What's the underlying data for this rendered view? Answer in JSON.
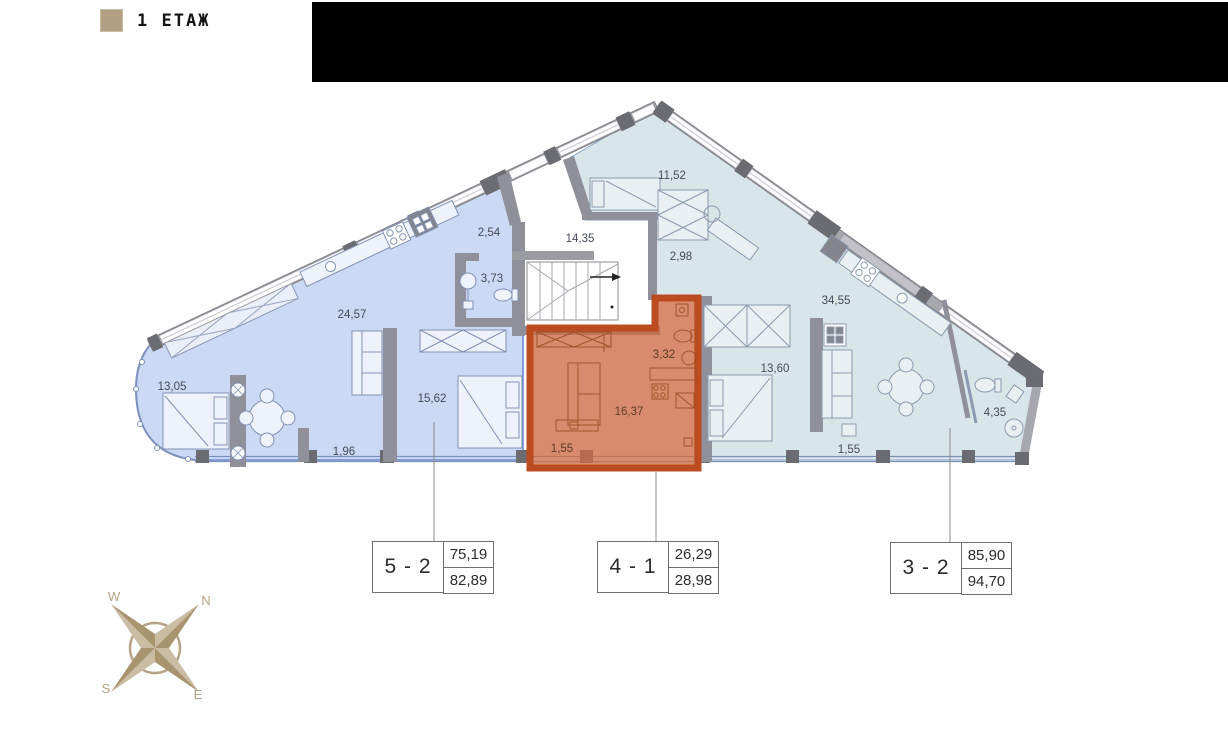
{
  "legend": {
    "floor_label": "1 ЕТАЖ",
    "swatch_color": "#b3a084"
  },
  "plan": {
    "rooms": [
      {
        "id": "left-13-05",
        "area": "13,05"
      },
      {
        "id": "left-24-57",
        "area": "24,57"
      },
      {
        "id": "left-2-54",
        "area": "2,54"
      },
      {
        "id": "left-3-73",
        "area": "3,73"
      },
      {
        "id": "left-15-62",
        "area": "15,62"
      },
      {
        "id": "left-1-96",
        "area": "1,96"
      },
      {
        "id": "stair-14-35",
        "area": "14,35"
      },
      {
        "id": "right-11-52",
        "area": "11,52"
      },
      {
        "id": "right-2-98",
        "area": "2,98"
      },
      {
        "id": "right-34-55",
        "area": "34,55"
      },
      {
        "id": "right-13-60",
        "area": "13,60"
      },
      {
        "id": "right-1-55",
        "area": "1,55"
      },
      {
        "id": "right-4-35",
        "area": "4,35"
      },
      {
        "id": "orange-3-32",
        "area": "3,32"
      },
      {
        "id": "orange-16-37",
        "area": "16,37"
      },
      {
        "id": "orange-1-55",
        "area": "1,55"
      }
    ]
  },
  "units": [
    {
      "number": "5 - 2",
      "upper_area": "75,19",
      "lower_area": "82,89"
    },
    {
      "number": "4 - 1",
      "upper_area": "26,29",
      "lower_area": "28,98"
    },
    {
      "number": "3 - 2",
      "upper_area": "85,90",
      "lower_area": "94,70"
    }
  ],
  "compass": {
    "n": "N",
    "e": "E",
    "s": "S",
    "w": "W"
  },
  "colors": {
    "unit_left_fill": "#ccd9f4",
    "unit_right_fill": "#d9e6e9",
    "highlight_fill": "#cd6b44",
    "highlight_border": "#bb4c20",
    "wall_gray": "#9b9ba1",
    "wall_dark": "#6b6b72",
    "legend_swatch": "#b3a084",
    "compass_tan": "#a8946f"
  }
}
